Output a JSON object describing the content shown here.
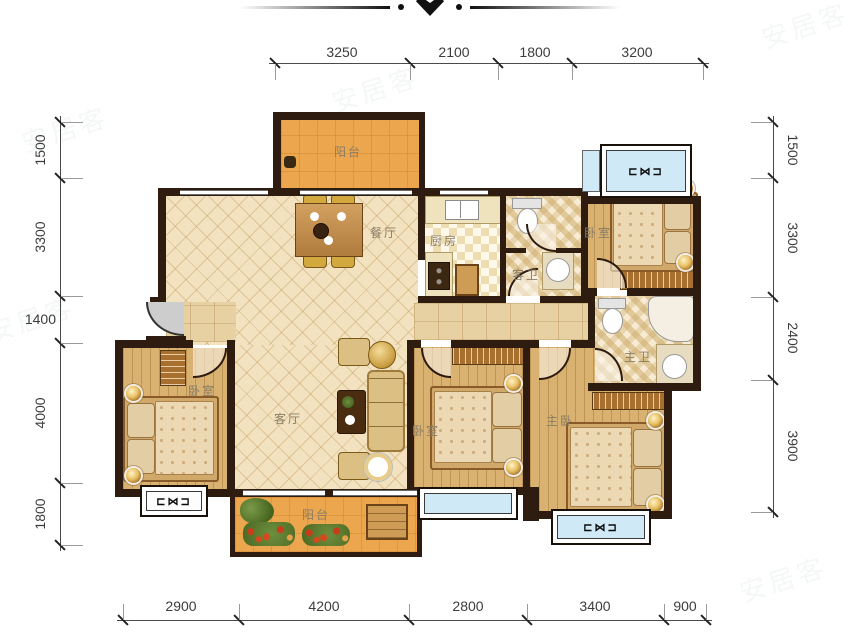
{
  "dimensions": {
    "top": [
      "3250",
      "2100",
      "1800",
      "3200"
    ],
    "bottom": [
      "2900",
      "4200",
      "2800",
      "3400",
      "900"
    ],
    "left": [
      "1500",
      "3300",
      "1400",
      "4000",
      "1800"
    ],
    "right": [
      "1500",
      "3300",
      "2400",
      "3900"
    ]
  },
  "rooms": {
    "balcony_top": "阳台",
    "dining": "餐厅",
    "kitchen": "厨房",
    "guest_bath": "客卫",
    "bedroom_ne": "卧室",
    "bedroom_w": "卧室",
    "living": "客厅",
    "bedroom_s": "卧室",
    "master_bath": "主卫",
    "master_bedroom": "主卧",
    "balcony_bottom": "阳台"
  },
  "window_glyph": "⊏⋈⊐",
  "watermark": "安居客",
  "colors": {
    "wall": "#2e1c10",
    "balcony_floor": "#eca64d",
    "wood_floor": "#d9b170",
    "tile_floor": "#f2e2c0",
    "hall_floor": "#e7d1a2",
    "window_blue": "#cfe9f7",
    "dim_text": "#3c3c3c",
    "label_text": "#8b7d66"
  }
}
